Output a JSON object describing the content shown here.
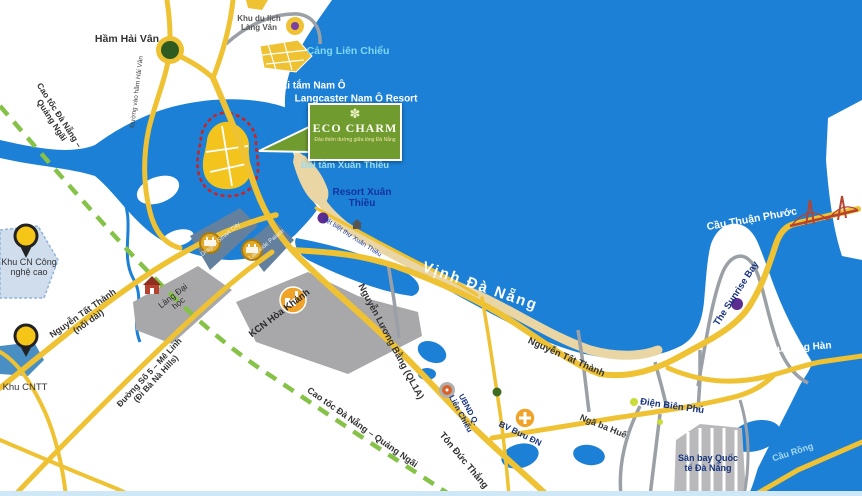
{
  "labels": {
    "ham_hai_van": "Hầm Hải Vân",
    "duong_vao_ham_hai_van": "Đường vào hầm Hải Vân",
    "khu_du_lich_lang_van": "Khu du lịch Làng Vân",
    "cang_lien_chieu": "Cảng Liên Chiểu",
    "bai_tam_nam_o": "Bãi tắm Nam Ô",
    "langcaster_nam_o_resort": "Langcaster  Nam Ô Resort",
    "bai_tam_xuan_thieu": "Bãi tắm Xuân Thiều",
    "resort_xuan_thieu": "Resort Xuân Thiều",
    "vet_biet_thu_xuan_thieu": "Vệt biệt thự Xuân Thiều",
    "vinh_da_nang": "Vịnh Đà Nẵng",
    "cau_thuan_phuoc": "Cầu Thuận Phước",
    "the_sunrise_bay": "The Sunrise Bay",
    "cau_song_han": "Cầu sông Hàn",
    "cau_rong": "Cầu Rồng",
    "khu_cn_cong_nghe_cao": "Khu CN Công nghệ cao",
    "khu_cntt": "Khu CNTT",
    "nguyen_tat_thanh_noi_dai_1": "Nguyễn Tất Thành",
    "nguyen_tat_thanh_noi_dai_2": "(nối dài)",
    "lang_dai_hoc": "Làng Đại học",
    "kcn_hoa_khanh": "KCN Hòa Khánh",
    "duong_so_5_1": "Đường Số 5 – Mê Linh",
    "duong_so_5_2": "(Đi Bà Nà Hills)",
    "cao_toc_da_nang_quang_ngai": "Cao tốc Đà Nẵng – Quảng Ngãi",
    "nguyen_luong_bang": "Nguyễn Lương Bằng (QL1A)",
    "ton_duc_thang": "Tôn Đức Thắng",
    "ubnd_1": "UBND Q.",
    "ubnd_2": "Liên Chiểu",
    "bv_buu_dien": "BV Bưu ĐN",
    "nga_ba_hue": "Ngã ba Huế",
    "dien_bien_phu": "Điện Biên Phủ",
    "san_bay": "Sân bay Quốc tế Đà Nẵng",
    "nguyen_tat_thanh": "Nguyễn Tất Thành",
    "dragon_smart_city": "Dragon Smart City",
    "lakeside_palace": "Lakeside Palace"
  },
  "eco_charm": {
    "name": "ECO CHARM",
    "tagline": "Đảo thiên đường giữa lòng Đà Nẵng",
    "emblem": "✽"
  },
  "colors": {
    "water": "#1b80d6",
    "road_primary": "#efc233",
    "road_secondary": "#9aa0a6",
    "expressway_dashed": "#86c247",
    "beach": "#e9d6a4",
    "industrial_zone": "#a8a8aa",
    "project_zone": "#64809f",
    "hightech_zone": "#cfdded",
    "it_zone": "#4a8fc4",
    "eco_box": "#6f9b2f",
    "island_fill": "#f2c41d",
    "island_boundary": "#cc2222",
    "pin": "#f5c518"
  },
  "icons": [
    "tunnel-icon",
    "scenic-dot-icon",
    "seaport-icon",
    "map-pin-icon",
    "university-icon",
    "factory-icon",
    "project-coin-icon",
    "resort-dot-icon",
    "committee-icon",
    "hospital-icon",
    "junction-dot-icon",
    "suspension-bridge-icon",
    "villa-icon"
  ]
}
